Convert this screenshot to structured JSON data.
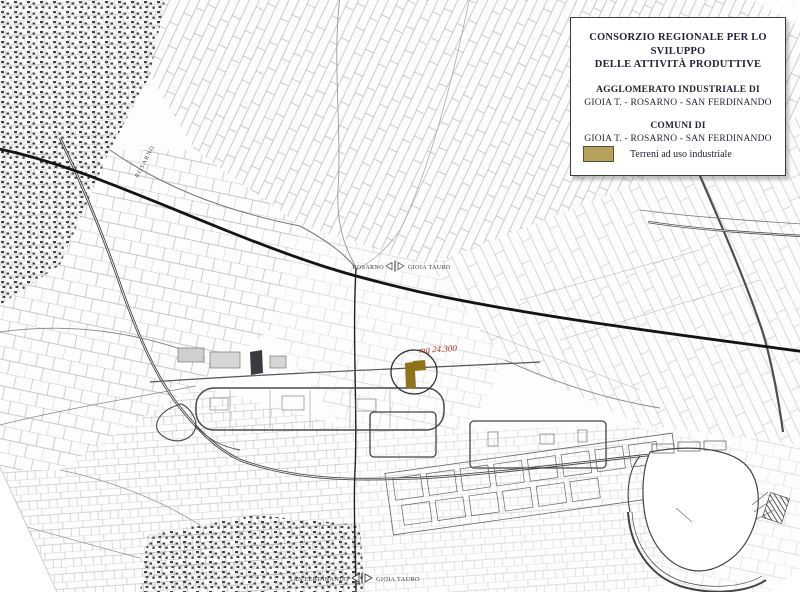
{
  "title_box": {
    "line1": "CONSORZIO REGIONALE PER LO SVILUPPO",
    "line2": "DELLE ATTIVITÀ PRODUTTIVE",
    "section1_title": "AGGLOMERATO INDUSTRIALE DI",
    "section1_sub": "GIOIA T. - ROSARNO - SAN FERDINANDO",
    "section2_title": "COMUNI DI",
    "section2_sub": "GIOIA T. - ROSARNO - SAN FERDINANDO",
    "legend_label": "Terreni ad uso industriale"
  },
  "map": {
    "area_label": "mq 24.300",
    "road_label": "ROSARNO",
    "boundary_marker_mid": {
      "left": "ROSARNO",
      "right": "GIOIA TAURO"
    },
    "boundary_marker_bottom": {
      "left": "SAN FERDINANDO",
      "right": "GIOIA TAURO"
    }
  },
  "colors": {
    "industrial_swatch": "#b5a25c",
    "industrial_parcel": "#8e721d",
    "area_label_red": "#b03028",
    "dark_building": "#3a3a41"
  }
}
